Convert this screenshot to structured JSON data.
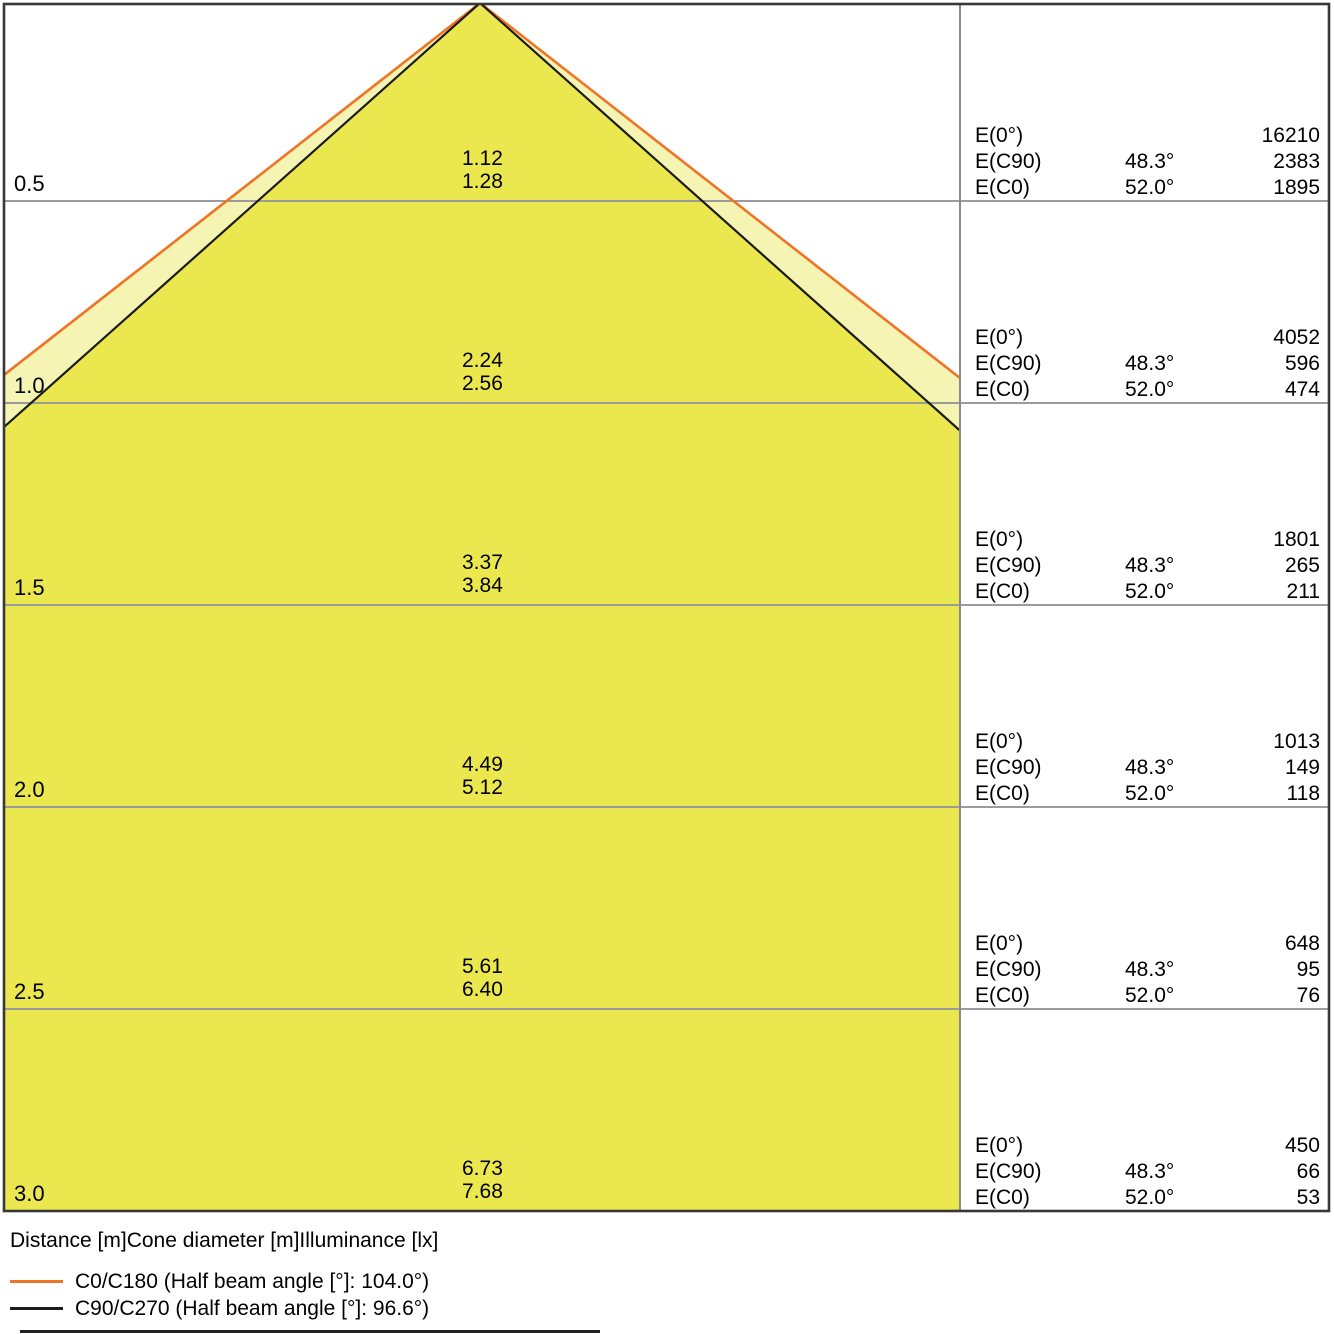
{
  "colors": {
    "c0_line": "#F07425",
    "c90_line": "#1B1B1B",
    "cone_outer_fill": "#F6F4B2",
    "cone_inner_fill": "#EBE74F",
    "grid_line": "#9B9B9B",
    "divider_line": "#8A8A8A",
    "border": "#383838",
    "text": "#000000"
  },
  "table_labels": {
    "e0": "E(0°)",
    "ec90": "E(C90)",
    "ec0": "E(C0)"
  },
  "footer": {
    "axis_caption": "Distance [m]Cone diameter [m]Illuminance [lx]",
    "legend": [
      {
        "label": "C0/C180 (Half beam angle [°]: 104.0°)",
        "color": "#F07425"
      },
      {
        "label": "C90/C270 (Half beam angle [°]: 96.6°)",
        "color": "#1B1B1B"
      }
    ]
  },
  "chart_data": {
    "type": "cone-diagram",
    "description": "Light cone diagram: cone diameter [m] and illuminance [lx] versus distance [m] below the luminaire",
    "beams": [
      {
        "name": "C0/C180",
        "half_beam_angle_deg": 104.0,
        "color": "#F07425"
      },
      {
        "name": "C90/C270",
        "half_beam_angle_deg": 96.6,
        "color": "#1B1B1B"
      }
    ],
    "half_angles": {
      "ec90": "48.3°",
      "ec0": "52.0°"
    },
    "columns": [
      "Distance [m]",
      "Cone diameter C90/C270 [m]",
      "Cone diameter C0/C180 [m]",
      "E(0°) [lx]",
      "E(C90) [lx]",
      "E(C0) [lx]"
    ],
    "rows": [
      {
        "distance": "0.5",
        "cone_c90": "1.12",
        "cone_c0": "1.28",
        "e0": "16210",
        "ec90": "2383",
        "ec0": "1895"
      },
      {
        "distance": "1.0",
        "cone_c90": "2.24",
        "cone_c0": "2.56",
        "e0": "4052",
        "ec90": "596",
        "ec0": "474"
      },
      {
        "distance": "1.5",
        "cone_c90": "3.37",
        "cone_c0": "3.84",
        "e0": "1801",
        "ec90": "265",
        "ec0": "211"
      },
      {
        "distance": "2.0",
        "cone_c90": "4.49",
        "cone_c0": "5.12",
        "e0": "1013",
        "ec90": "149",
        "ec0": "118"
      },
      {
        "distance": "2.5",
        "cone_c90": "5.61",
        "cone_c0": "6.40",
        "e0": "648",
        "ec90": "95",
        "ec0": "76"
      },
      {
        "distance": "3.0",
        "cone_c90": "6.73",
        "cone_c0": "7.68",
        "e0": "450",
        "ec90": "66",
        "ec0": "53"
      }
    ]
  }
}
